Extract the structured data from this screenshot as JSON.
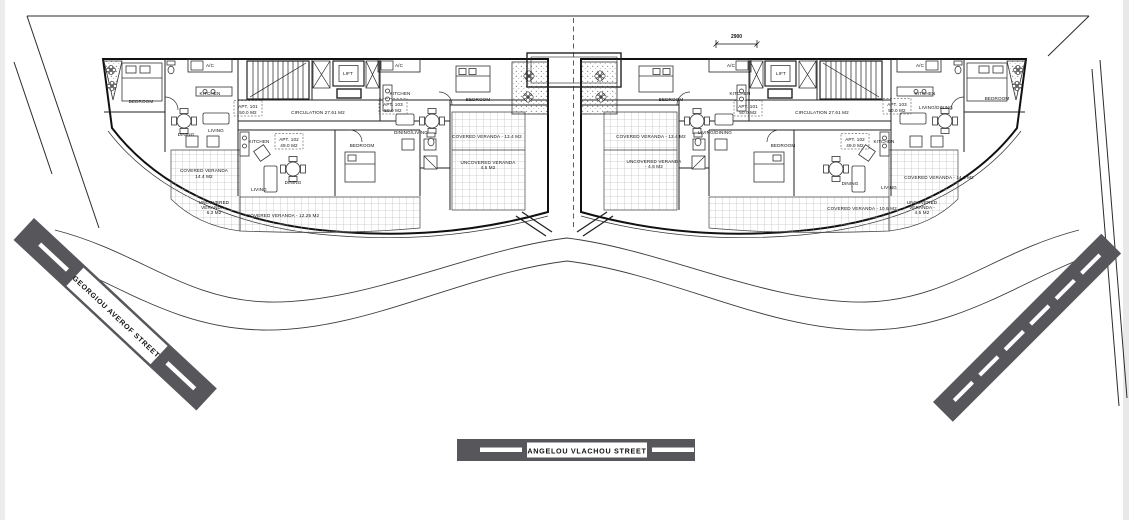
{
  "page": {
    "background": "#ffffff",
    "edge_strip_color": "#ececec",
    "line_color": "#1b1b1b",
    "street_color": "#56565b",
    "street_label_bg": "#ffffff"
  },
  "dimension": {
    "value": "2900"
  },
  "streets": {
    "left": {
      "name": "GEORGIOU AVEROF STREET"
    },
    "bottom": {
      "name": "ANGELOU VLACHOU STREET"
    },
    "right": {
      "name": ""
    }
  },
  "plan": {
    "left_wing_labels": [
      "BEDROOM",
      "A/C",
      "KITCHEN",
      "DINING",
      "LIVING",
      "APT. 101",
      "50.0 M2",
      "CIRCULATION 27.61 M2",
      "LIFT",
      "A/C",
      "KITCHEN",
      "APT. 103",
      "50.0 M2",
      "DINING/LIVING",
      "BEDROOM",
      "BEDROOM",
      "KITCHEN",
      "APT. 102",
      "49.0 M2",
      "LIVING",
      "DINING",
      "COVERED VERANDA",
      "14.4 M2",
      "UNCOVERED",
      "VERANDA -",
      "6.3 M2",
      "COVERED VERANDA - 12.25 M2",
      "COVERED VERANDA - 13.4 M2",
      "UNCOVERED VERANDA",
      "4.5 M2"
    ],
    "right_wing_labels": [
      "BEDROOM",
      "A/C",
      "KITCHEN",
      "APT. 101",
      "50.0 M2",
      "LIVING/DINING",
      "LIFT",
      "CIRCULATION 27.61 M2",
      "COVERED VERANDA - 13.4 M2",
      "UNCOVERED VERANDA",
      "- 4.6 M2",
      "BEDROOM",
      "APT. 102",
      "49.0 M2",
      "KITCHEN",
      "DINING",
      "LIVING",
      "COVERED VERANDA - 10.6 M2",
      "A/C",
      "KITCHEN",
      "APT. 103",
      "50.0 M2",
      "LIVING/DINING",
      "BEDROOM",
      "COVERED VERANDA - 14.0 M2",
      "UNCOVERED",
      "VERANDA -",
      "4.5 M2"
    ]
  }
}
